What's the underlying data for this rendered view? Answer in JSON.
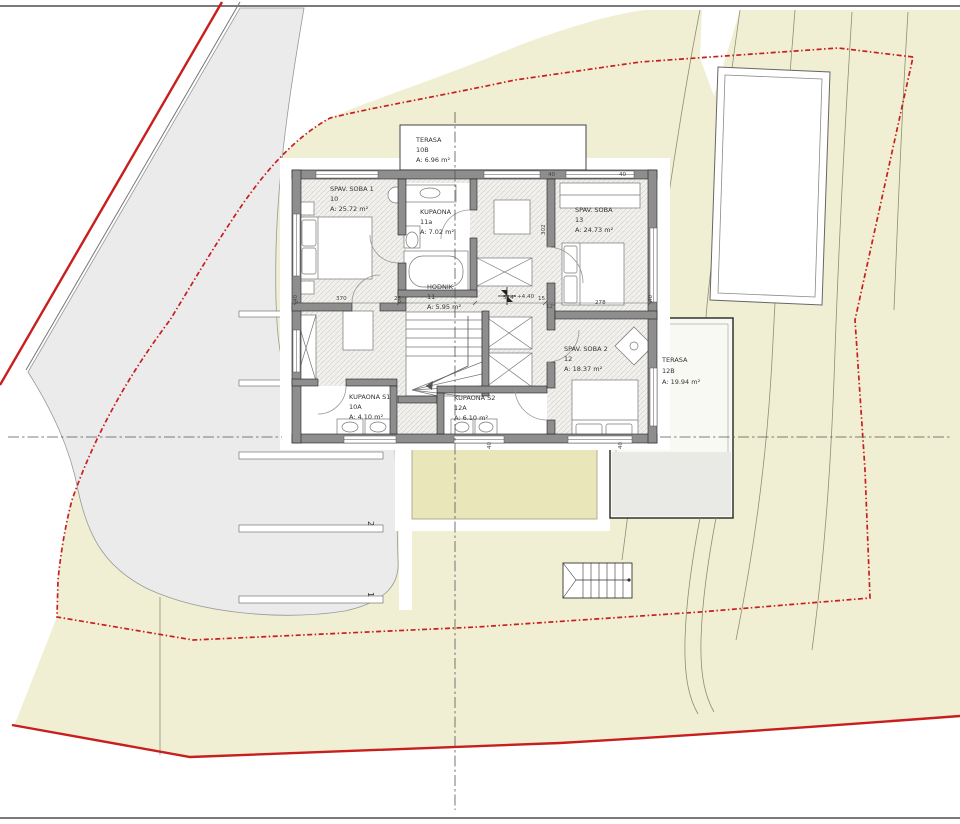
{
  "rooms": [
    {
      "name": "SPAV. SOBA 1",
      "id": "10",
      "area": "A: 25.72 m²"
    },
    {
      "name": "KUPAONA",
      "id": "11a",
      "area": "A: 7.02 m²"
    },
    {
      "name": "SPAV. SOBA",
      "id": "13",
      "area": "A: 24.73 m²"
    },
    {
      "name": "HODNIK",
      "id": "11",
      "area": "A: 5.95 m²"
    },
    {
      "name": "SPAV. SOBA 2",
      "id": "12",
      "area": "A: 18.37 m²"
    },
    {
      "name": "KUPAONA S1",
      "id": "10A",
      "area": "A: 4.10 m²"
    },
    {
      "name": "KUPAONA S2",
      "id": "12A",
      "area": "A: 6.10 m²"
    },
    {
      "name": "TERASA",
      "id": "10B",
      "area": "A: 6.96 m²"
    },
    {
      "name": "TERASA",
      "id": "12B",
      "area": "A: 19.94 m²"
    }
  ],
  "level_marker": "+4.40",
  "dims": [
    "40",
    "370",
    "25",
    "514⁵",
    "15",
    "12⁵",
    "278",
    "40",
    "40",
    "40",
    "302",
    "40",
    "40"
  ],
  "parking": [
    "1",
    "2"
  ],
  "colors": {
    "boundary_red": "#c81e1e",
    "terrain_yellow": "#f1efd3",
    "road_gray": "#ebebeb",
    "roof_terrace_yellow": "#e9e6ba",
    "wall_gray": "#8e8e8e"
  }
}
